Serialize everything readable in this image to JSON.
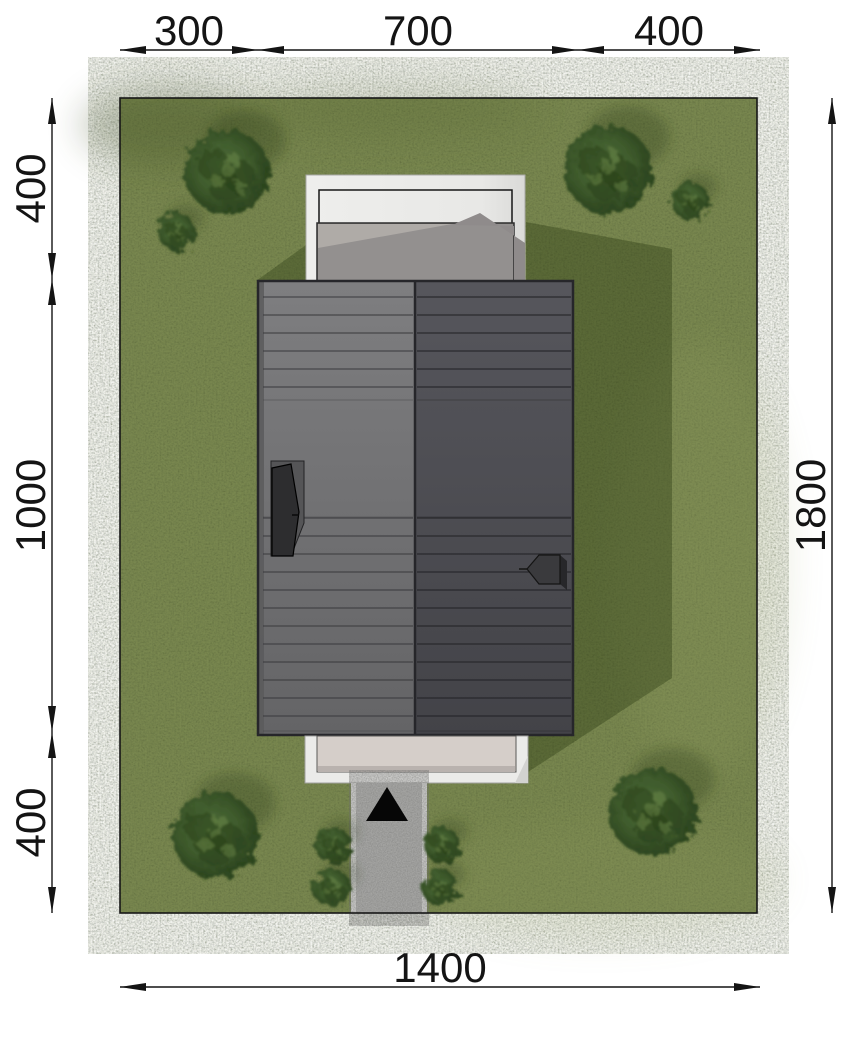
{
  "drawing": {
    "type": "architectural-site-plan-top-view",
    "units_note": ""
  },
  "dims": {
    "top": {
      "orient": "h",
      "line": 50,
      "stops": [
        120,
        258,
        578,
        760
      ],
      "labels": [
        "300",
        "700",
        "400"
      ],
      "text_off": -5
    },
    "left": {
      "orient": "v",
      "line": 52,
      "stops": [
        98,
        279,
        732,
        913
      ],
      "labels": [
        "400",
        "1000",
        "400"
      ],
      "text_off": -7
    },
    "right": {
      "orient": "v",
      "line": 832,
      "stops": [
        98,
        913
      ],
      "labels": [
        "1800"
      ],
      "text_off": -7
    },
    "bottom": {
      "orient": "h",
      "line": 987,
      "stops": [
        120,
        760
      ],
      "labels": [
        "1400"
      ],
      "text_off": -5
    }
  },
  "trees": [
    {
      "x": 227,
      "y": 172,
      "r": 42,
      "kind": "tree"
    },
    {
      "x": 177,
      "y": 232,
      "r": 19,
      "kind": "bush"
    },
    {
      "x": 608,
      "y": 170,
      "r": 44,
      "kind": "tree"
    },
    {
      "x": 690,
      "y": 201,
      "r": 19,
      "kind": "bush"
    },
    {
      "x": 215,
      "y": 835,
      "r": 43,
      "kind": "tree"
    },
    {
      "x": 333,
      "y": 845,
      "r": 18,
      "kind": "bush"
    },
    {
      "x": 332,
      "y": 888,
      "r": 19,
      "kind": "bush"
    },
    {
      "x": 442,
      "y": 845,
      "r": 18,
      "kind": "bush"
    },
    {
      "x": 440,
      "y": 888,
      "r": 18,
      "kind": "bush"
    },
    {
      "x": 653,
      "y": 812,
      "r": 44,
      "kind": "tree"
    }
  ],
  "roof_seams": {
    "upper": [
      297,
      315,
      333,
      351,
      369,
      387
    ],
    "lower": [
      518,
      536,
      554,
      572,
      590,
      608,
      626,
      644,
      662,
      680,
      698,
      716
    ],
    "faint": [
      400,
      517,
      731
    ]
  },
  "colors": {
    "grass": "#7d8b52",
    "grass_shadow": "#1c2a06",
    "roof_left_top": "#7e7e80",
    "roof_left_bottom": "#646466",
    "roof_right_top": "#56565c",
    "roof_right_bottom": "#434348",
    "terrace_white": "#ebebe9",
    "deck_gray": "#93908f",
    "deck_light": "#b2aeaa",
    "porch_inner": "#d5cec9",
    "driveway_gravel": "#b3b3b1",
    "dimension_ink": "#141414"
  }
}
